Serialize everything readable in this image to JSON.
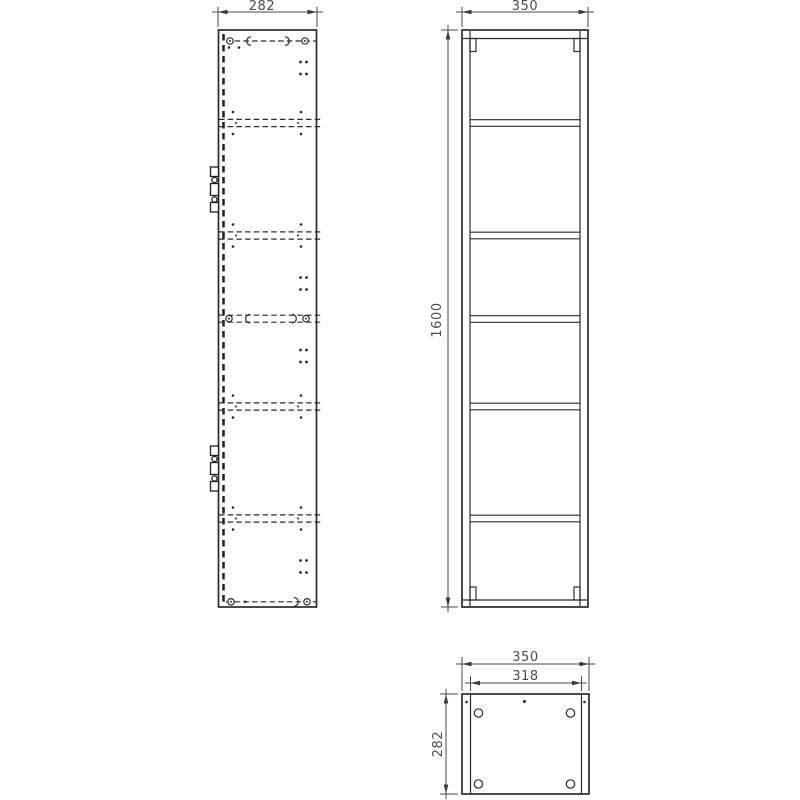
{
  "views": {
    "side": {
      "width": "282"
    },
    "front": {
      "width": "350",
      "height": "1600"
    },
    "bottom": {
      "outer_width": "350",
      "inner_width": "318",
      "depth": "282"
    }
  },
  "colors": {
    "line": "#2b2b2b",
    "dimension_text": "#4b4b4b",
    "background": "#ffffff"
  },
  "symbols": {
    "cam_lock": "small-circle-with-pin",
    "dowel": "c-shaped-arc",
    "hinge_plate": "tabs-with-screw-circles",
    "shelf_pin_hole": "small-dot",
    "fixing_hole": "open-circle",
    "dimension_arrow": "filled-triangle"
  }
}
